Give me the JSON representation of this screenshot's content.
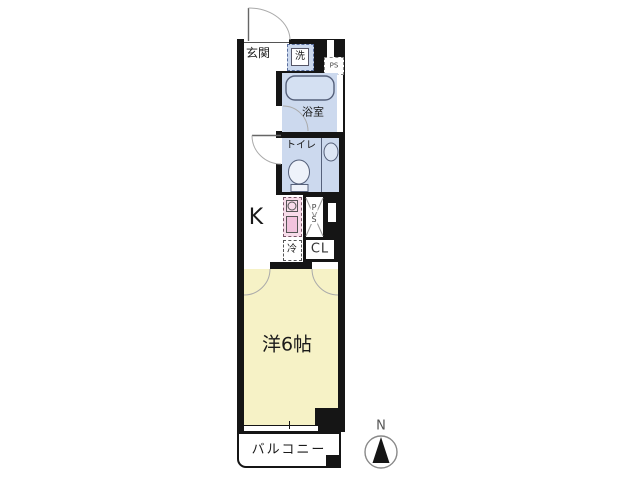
{
  "title": "apartment-floorplan",
  "rooms": {
    "genkan": {
      "label": "玄関"
    },
    "washer": {
      "label": "洗"
    },
    "ps_upper": {
      "label": "PS"
    },
    "bathroom": {
      "label": "浴室"
    },
    "toilet": {
      "label": "トイレ"
    },
    "kitchen": {
      "label": "K"
    },
    "ps_mid": {
      "p": "P",
      "s": "S"
    },
    "fridge": {
      "label": "冷"
    },
    "closet": {
      "label": "CL"
    },
    "main_room": {
      "label": "洋6帖"
    },
    "balcony": {
      "label": "バルコニー"
    }
  },
  "compass": {
    "label": "N"
  },
  "colors": {
    "wall": "#151515",
    "wet_area_blue": "#ccd9ee",
    "room_yellow": "#f6f2c6",
    "kitchen_unit_pink": "#f2c3dd",
    "kitchen_unit_pink_light": "#f8dcea",
    "fixture_outline": "#55607a",
    "door_arc_gray": "#aaaaaa"
  }
}
